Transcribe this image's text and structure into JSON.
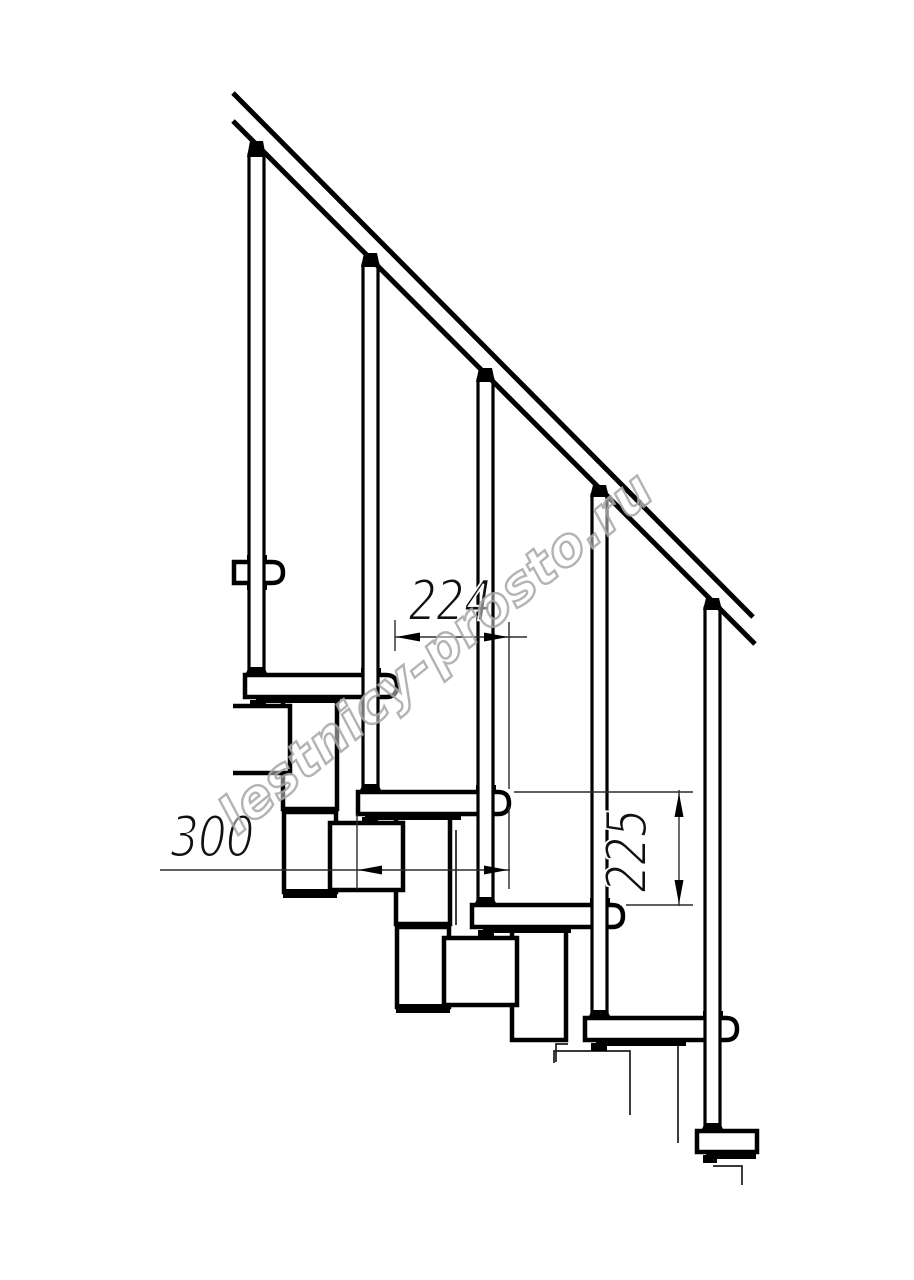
{
  "meta": {
    "background": "#ffffff",
    "line_color": "#000000",
    "thin_line_color": "#2b2b2b",
    "watermark_color": "#a6a6a6",
    "drawing_subject": "modular staircase side view fragment"
  },
  "watermark": {
    "text": "lestnicy-prosto.ru",
    "transform": "translate(447,666) rotate(-39)"
  },
  "dimensions": {
    "run": {
      "label": "224",
      "value": 224,
      "orientation": "horizontal",
      "transform": "translate(450,620) scale(0.8,1)"
    },
    "depth": {
      "label": "300",
      "value": 300,
      "orientation": "horizontal",
      "transform": "translate(212,856) scale(0.8,1)"
    },
    "rise": {
      "label": "225",
      "value": 225,
      "orientation": "vertical",
      "transform": "translate(646,851) rotate(-90) scale(0.8,1)"
    }
  },
  "drawing": {
    "primitives": [
      {
        "n": "module-v2-top-cap",
        "t": "rect",
        "x": 283,
        "y": 805,
        "w": 54,
        "h": 9,
        "c": "bk"
      },
      {
        "n": "module-v2-box",
        "t": "rect",
        "x": 284,
        "y": 812,
        "w": 52,
        "h": 80,
        "c": "k45 wf"
      },
      {
        "n": "module-v2-bottom-cap",
        "t": "rect",
        "x": 283,
        "y": 889,
        "w": 54,
        "h": 9,
        "c": "bk"
      },
      {
        "n": "module-v3-top-cap",
        "t": "rect",
        "x": 396,
        "y": 920,
        "w": 54,
        "h": 9,
        "c": "bk"
      },
      {
        "n": "module-v3-box",
        "t": "rect",
        "x": 397,
        "y": 927,
        "w": 52,
        "h": 80,
        "c": "k45 wf"
      },
      {
        "n": "module-v3-bottom-cap",
        "t": "rect",
        "x": 396,
        "y": 1004,
        "w": 54,
        "h": 9,
        "c": "bk"
      },
      {
        "n": "column-step2",
        "t": "rect",
        "x": 283,
        "y": 697,
        "w": 54,
        "h": 112,
        "c": "k45 wf"
      },
      {
        "n": "column-step3",
        "t": "rect",
        "x": 396,
        "y": 814,
        "w": 54,
        "h": 110,
        "c": "k45 wf"
      },
      {
        "n": "column-step4",
        "t": "rect",
        "x": 512,
        "y": 926,
        "w": 54,
        "h": 114,
        "c": "k45 wf"
      },
      {
        "n": "module-box-step2",
        "t": "path",
        "d": "M233,706 H290 V773 H233",
        "c": "k45 wf"
      },
      {
        "n": "module-box-step3",
        "t": "rect",
        "x": 330,
        "y": 823,
        "w": 73,
        "h": 67,
        "c": "k45 wf"
      },
      {
        "n": "module-box-step4",
        "t": "rect",
        "x": 444,
        "y": 938,
        "w": 73,
        "h": 67,
        "c": "k45 wf"
      },
      {
        "n": "hidden-edge-step3",
        "t": "line",
        "x1": 456,
        "y1": 830,
        "x2": 456,
        "y2": 925,
        "c": "thin"
      },
      {
        "n": "hidden-jog-step4",
        "t": "path",
        "d": "M568,1044 H556 V1062",
        "c": "thin"
      },
      {
        "n": "module-box-step5-hidden",
        "t": "path",
        "d": "M554,1063 V1051 H630 V1115",
        "c": "thin"
      },
      {
        "n": "hidden-edge-step5",
        "t": "line",
        "x1": 678,
        "y1": 1045,
        "x2": 678,
        "y2": 1143,
        "c": "thin"
      },
      {
        "n": "hidden-jog-step6",
        "t": "path",
        "d": "M713,1166 H742 V1185",
        "c": "thin"
      },
      {
        "n": "tread-1",
        "t": "path",
        "d": "M234,562 H272 Q283,562 283,572.5 Q283,583 272,583 H234 Z",
        "c": "k45 wf"
      },
      {
        "n": "tread-2",
        "t": "path",
        "d": "M245,675 H386 Q397,675 397,686 Q397,697 386,697 H245 Z",
        "c": "k45 wf"
      },
      {
        "n": "tread-3",
        "t": "path",
        "d": "M358,792 H498 Q509,792 509,803 Q509,814 498,814 H358 Z",
        "c": "k45 wf"
      },
      {
        "n": "tread-4",
        "t": "path",
        "d": "M472,905 H612 Q623,905 623,916 Q623,927 612,927 H472 Z",
        "c": "k45 wf"
      },
      {
        "n": "tread-5",
        "t": "path",
        "d": "M585,1018 H726 Q737,1018 737,1029 Q737,1040 726,1040 H585 Z",
        "c": "k45 wf"
      },
      {
        "n": "tread-6",
        "t": "path",
        "d": "M697,1131 H757 V1152 H697 Z",
        "c": "k45 wf"
      },
      {
        "n": "tread1-under-collar",
        "t": "rect",
        "x": 247,
        "y": 583,
        "w": 20,
        "h": 7,
        "c": "bk"
      },
      {
        "n": "tread2-under-strip",
        "t": "rect",
        "x": 256,
        "y": 697,
        "w": 84,
        "h": 6,
        "c": "bk"
      },
      {
        "n": "tread2-mount-tab",
        "t": "rect",
        "x": 250,
        "y": 700,
        "w": 16,
        "h": 8,
        "c": "bk"
      },
      {
        "n": "tread3-under-strip",
        "t": "rect",
        "x": 365,
        "y": 814,
        "w": 96,
        "h": 6,
        "c": "bk"
      },
      {
        "n": "tread3-mount-tab",
        "t": "rect",
        "x": 362,
        "y": 817,
        "w": 16,
        "h": 8,
        "c": "bk"
      },
      {
        "n": "tread4-under-strip",
        "t": "rect",
        "x": 483,
        "y": 927,
        "w": 88,
        "h": 6,
        "c": "bk"
      },
      {
        "n": "tread4-mount-tab",
        "t": "rect",
        "x": 478,
        "y": 930,
        "w": 16,
        "h": 8,
        "c": "bk"
      },
      {
        "n": "tread5-under-strip",
        "t": "rect",
        "x": 596,
        "y": 1040,
        "w": 90,
        "h": 6,
        "c": "bk"
      },
      {
        "n": "tread5-mount-tab",
        "t": "rect",
        "x": 591,
        "y": 1043,
        "w": 16,
        "h": 8,
        "c": "bk"
      },
      {
        "n": "tread6-under-strip",
        "t": "rect",
        "x": 706,
        "y": 1152,
        "w": 50,
        "h": 7,
        "c": "bk"
      },
      {
        "n": "tread6-mount-tab",
        "t": "rect",
        "x": 703,
        "y": 1155,
        "w": 14,
        "h": 8,
        "c": "bk"
      },
      {
        "n": "baluster1-collar",
        "t": "rect",
        "x": 247,
        "y": 555,
        "w": 20,
        "h": 8,
        "c": "bk"
      },
      {
        "n": "baluster2-collar",
        "t": "rect",
        "x": 361,
        "y": 668,
        "w": 20,
        "h": 8,
        "c": "bk"
      },
      {
        "n": "baluster3-collar",
        "t": "rect",
        "x": 476,
        "y": 785,
        "w": 20,
        "h": 8,
        "c": "bk"
      },
      {
        "n": "baluster4-collar",
        "t": "rect",
        "x": 590,
        "y": 898,
        "w": 20,
        "h": 8,
        "c": "bk"
      },
      {
        "n": "baluster5-collar",
        "t": "rect",
        "x": 703,
        "y": 1011,
        "w": 20,
        "h": 8,
        "c": "bk"
      },
      {
        "n": "baluster-1",
        "t": "rect",
        "x": 249,
        "y": 155,
        "w": 15,
        "h": 520,
        "c": "k3 wf"
      },
      {
        "n": "baluster-2",
        "t": "rect",
        "x": 363,
        "y": 265,
        "w": 15,
        "h": 527,
        "c": "k3 wf"
      },
      {
        "n": "baluster-3",
        "t": "rect",
        "x": 478,
        "y": 380,
        "w": 15,
        "h": 525,
        "c": "k3 wf"
      },
      {
        "n": "baluster-4",
        "t": "rect",
        "x": 592,
        "y": 495,
        "w": 15,
        "h": 523,
        "c": "k3 wf"
      },
      {
        "n": "baluster-5",
        "t": "rect",
        "x": 705,
        "y": 608,
        "w": 15,
        "h": 523,
        "c": "k3 wf"
      },
      {
        "n": "baluster1-foot",
        "t": "poly",
        "p": "245,675 268,675 264,667 249,667",
        "c": "bk"
      },
      {
        "n": "baluster2-foot",
        "t": "poly",
        "p": "359,792 382,792 378,784 363,784",
        "c": "bk"
      },
      {
        "n": "baluster3-foot",
        "t": "poly",
        "p": "474,905 497,905 493,897 478,897",
        "c": "bk"
      },
      {
        "n": "baluster4-foot",
        "t": "poly",
        "p": "588,1018 611,1018 607,1010 592,1010",
        "c": "bk"
      },
      {
        "n": "baluster5-foot",
        "t": "poly",
        "p": "701,1131 724,1131 720,1123 705,1123",
        "c": "bk"
      },
      {
        "n": "baluster1-rail-connector",
        "t": "poly",
        "p": "247,157 266,157 263,141 250,141",
        "c": "bk"
      },
      {
        "n": "baluster2-rail-connector",
        "t": "poly",
        "p": "361,267 380,267 377,253 364,253",
        "c": "bk"
      },
      {
        "n": "baluster3-rail-connector",
        "t": "poly",
        "p": "476,382 495,382 492,368 479,368",
        "c": "bk"
      },
      {
        "n": "baluster4-rail-connector",
        "t": "poly",
        "p": "590,497 609,497 606,485 593,485",
        "c": "bk"
      },
      {
        "n": "baluster5-rail-connector",
        "t": "poly",
        "p": "703,610 722,610 719,598 706,598",
        "c": "bk"
      },
      {
        "n": "handrail-top-line",
        "t": "line",
        "x1": 233,
        "y1": 93,
        "x2": 753,
        "y2": 617,
        "c": "k5"
      },
      {
        "n": "handrail-bottom-line",
        "t": "line",
        "x1": 233,
        "y1": 121,
        "x2": 755,
        "y2": 644,
        "c": "k5"
      },
      {
        "n": "dim224-extension-left",
        "t": "line",
        "x1": 395,
        "y1": 620,
        "x2": 395,
        "y2": 651,
        "c": "dim"
      },
      {
        "n": "dim224-extension-right",
        "t": "line",
        "x1": 509,
        "y1": 622,
        "x2": 509,
        "y2": 789,
        "c": "dim"
      },
      {
        "n": "dim224-line",
        "t": "line",
        "x1": 395,
        "y1": 637,
        "x2": 527,
        "y2": 637,
        "c": "dim"
      },
      {
        "n": "dim224-arrow-left",
        "t": "poly",
        "p": "396,637 420,632.5 420,641.5",
        "c": "bk"
      },
      {
        "n": "dim224-arrow-right",
        "t": "poly",
        "p": "508,637 484,632.5 484,641.5",
        "c": "bk"
      },
      {
        "n": "dim300-line",
        "t": "line",
        "x1": 160,
        "y1": 870,
        "x2": 510,
        "y2": 870,
        "c": "dim"
      },
      {
        "n": "dim300-extension-left",
        "t": "line",
        "x1": 357,
        "y1": 814,
        "x2": 357,
        "y2": 889,
        "c": "dim"
      },
      {
        "n": "dim300-extension-right",
        "t": "line",
        "x1": 509,
        "y1": 807,
        "x2": 509,
        "y2": 889,
        "c": "dim"
      },
      {
        "n": "dim300-arrow-left",
        "t": "poly",
        "p": "358,870 382,865.5 382,874.5",
        "c": "bk"
      },
      {
        "n": "dim300-arrow-right",
        "t": "poly",
        "p": "508,870 484,865.5 484,874.5",
        "c": "bk"
      },
      {
        "n": "dim225-extension-top",
        "t": "line",
        "x1": 514,
        "y1": 792,
        "x2": 693,
        "y2": 792,
        "c": "dim"
      },
      {
        "n": "dim225-extension-bottom",
        "t": "line",
        "x1": 626,
        "y1": 905,
        "x2": 693,
        "y2": 905,
        "c": "dim"
      },
      {
        "n": "dim225-line",
        "t": "line",
        "x1": 679,
        "y1": 790,
        "x2": 679,
        "y2": 906,
        "c": "dim"
      },
      {
        "n": "dim225-arrow-up",
        "t": "poly",
        "p": "679,793 674.5,817 683.5,817",
        "c": "bk"
      },
      {
        "n": "dim225-arrow-down",
        "t": "poly",
        "p": "679,904 674.5,880 683.5,880",
        "c": "bk"
      }
    ]
  }
}
